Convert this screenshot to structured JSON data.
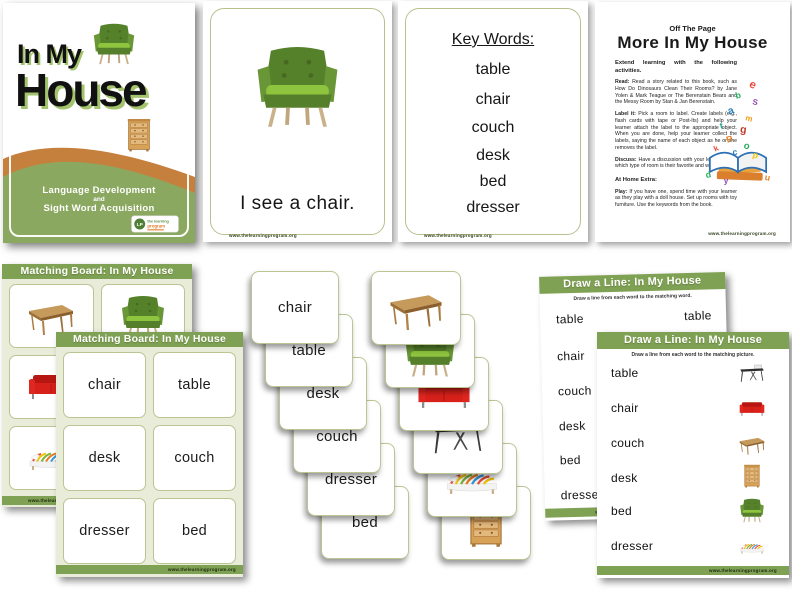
{
  "cover": {
    "title_line1": "In My",
    "title_line2": "House",
    "tagline_line1": "Language Development",
    "tagline_line2": "and",
    "tagline_line3": "Sight Word Acquisition",
    "chair_image": "green-armchair",
    "dresser_image": "wooden-dresser",
    "logo_icon": "learning-program-logo"
  },
  "flashcard": {
    "image": "green-armchair",
    "caption": "I see a chair."
  },
  "keywords_page": {
    "heading": "Key Words:",
    "words": [
      "table",
      "chair",
      "couch",
      "desk",
      "bed",
      "dresser"
    ]
  },
  "activity_page": {
    "kicker": "Off The Page",
    "title": "More In My House",
    "intro": "Extend learning with the following activities.",
    "read_label": "Read:",
    "read_text": "Read a story related to this book, such as How Do Dinosaurs Clean Their Rooms? by Jane Yolen & Mark Teague or The Berenstain Bears and the Messy Room by Stan & Jan Berenstain.",
    "label_label": "Label it:",
    "label_text": "Pick a room to label. Create labels (e.g., flash cards with tape or Post-Its) and help your learner attach the label to the appropriate object. When you are done, help your learner collect the labels, saying the name of each object as he or she removes the label.",
    "discuss_label": "Discuss:",
    "discuss_text": "Have a discussion with your learner about which type of room is their favorite and why.",
    "extra_heading": "At Home Extra:",
    "play_label": "Play:",
    "play_text": "If you have one, spend time with your learner as they play with a doll house. Set up rooms with toy furniture. Use the keywords from the book.",
    "clipart": "book-letters-burst"
  },
  "matching_board_images": {
    "title": "Matching Board: In My House",
    "cells": [
      "wooden-table",
      "green-armchair",
      "red-couch",
      "black-desk",
      "striped-bed",
      "wooden-dresser"
    ]
  },
  "matching_board_words": {
    "title": "Matching Board: In My House",
    "cells": [
      "chair",
      "table",
      "desk",
      "couch",
      "dresser",
      "bed"
    ]
  },
  "word_cards": [
    "chair",
    "table",
    "desk",
    "couch",
    "dresser",
    "bed"
  ],
  "picture_cards": [
    "wooden-table",
    "green-armchair",
    "red-couch",
    "black-desk",
    "striped-bed",
    "wooden-dresser"
  ],
  "draw_line_words_page": {
    "title": "Draw a Line: In My House",
    "subtitle": "Draw a line from each word to the matching word.",
    "left_words": [
      "table",
      "chair",
      "couch",
      "desk",
      "bed",
      "dresser"
    ],
    "right_words": [
      "table"
    ]
  },
  "draw_line_pictures_page": {
    "title": "Draw a Line: In My House",
    "subtitle": "Draw a line from each word to the matching picture.",
    "rows": [
      {
        "word": "table",
        "image": "black-desk"
      },
      {
        "word": "chair",
        "image": "red-couch"
      },
      {
        "word": "couch",
        "image": "wooden-table"
      },
      {
        "word": "desk",
        "image": "wooden-dresser"
      },
      {
        "word": "bed",
        "image": "green-armchair"
      },
      {
        "word": "dresser",
        "image": "striped-bed"
      }
    ]
  },
  "footer_text": "www.thelearningprogram.org",
  "colors": {
    "accent_green": "#7fa153",
    "sheet_bg": "#e9ecd9",
    "card_border": "#b9c694",
    "cover_orange": "#c5803e",
    "cover_green": "#8ba860",
    "title_shadow": "#a3c46d",
    "couch_red": "#d7201a"
  }
}
